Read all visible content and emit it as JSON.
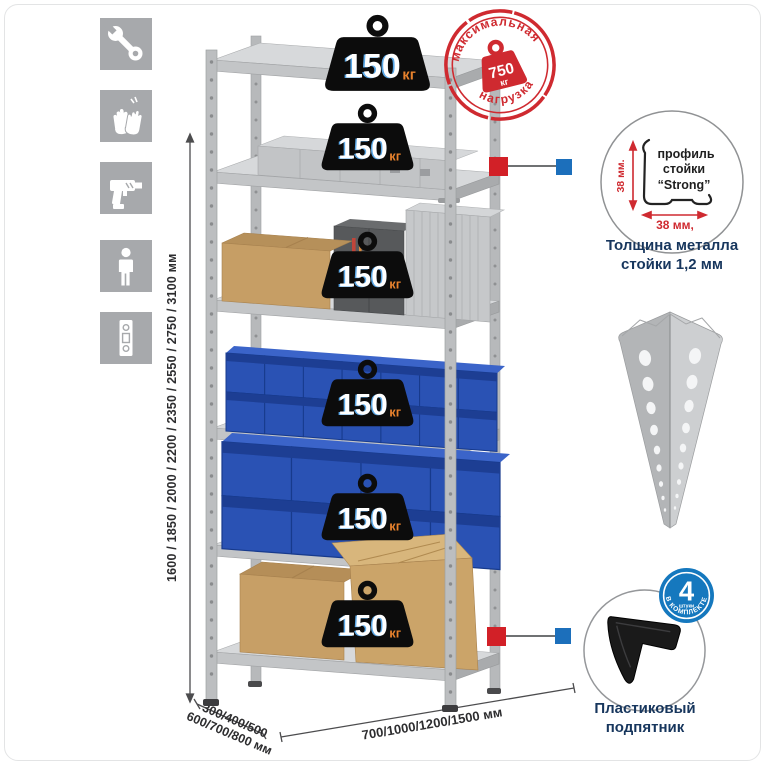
{
  "canvas": {
    "background": "#ffffff"
  },
  "assembly_icons": {
    "tile_color": "#a7a9ac",
    "items": [
      {
        "icon": "wrench-icon"
      },
      {
        "icon": "gloves-icon"
      },
      {
        "icon": "drill-icon"
      },
      {
        "icon": "person-icon"
      },
      {
        "icon": "rack-post-icon"
      }
    ]
  },
  "dimensions": {
    "height": "1600 / 1850 / 2000 / 2200 / 2350 / 2550 / 2750 / 3100 мм",
    "depth_line1": "300/400/500",
    "depth_line2": "600/700/800 мм",
    "width": "700/1000/1200/1500 мм"
  },
  "rack": {
    "shelf_count": 6,
    "badges": [
      {
        "value": "150",
        "unit": "кг"
      },
      {
        "value": "150",
        "unit": "кг"
      },
      {
        "value": "150",
        "unit": "кг"
      },
      {
        "value": "150",
        "unit": "кг"
      },
      {
        "value": "150",
        "unit": "кг"
      },
      {
        "value": "150",
        "unit": "кг"
      }
    ]
  },
  "max_load_stamp": {
    "arc_top": "максимальная",
    "arc_bottom": "нагрузка",
    "value": "750",
    "unit": "кг",
    "color": "#cf2a30"
  },
  "profile_detail": {
    "dim_vertical": "38 мм.",
    "dim_horizontal": "38 мм,",
    "label_line1": "профиль",
    "label_line2": "стойки",
    "label_line3": "“Strong”",
    "caption_line1": "Толщина металла",
    "caption_line2": "стойки 1,2 мм"
  },
  "foot_detail": {
    "badge_value": "4",
    "badge_word": "штуки",
    "badge_arc": "В КОМПЛЕКТЕ",
    "caption_line1": "Пластиковый",
    "caption_line2": "подпятник"
  },
  "colors": {
    "accent_red": "#d22027",
    "accent_blue": "#1c6fbb",
    "caption_navy": "#17365d",
    "badge_unit_orange": "#e8822d",
    "bin_blue": "#2a52b4"
  }
}
